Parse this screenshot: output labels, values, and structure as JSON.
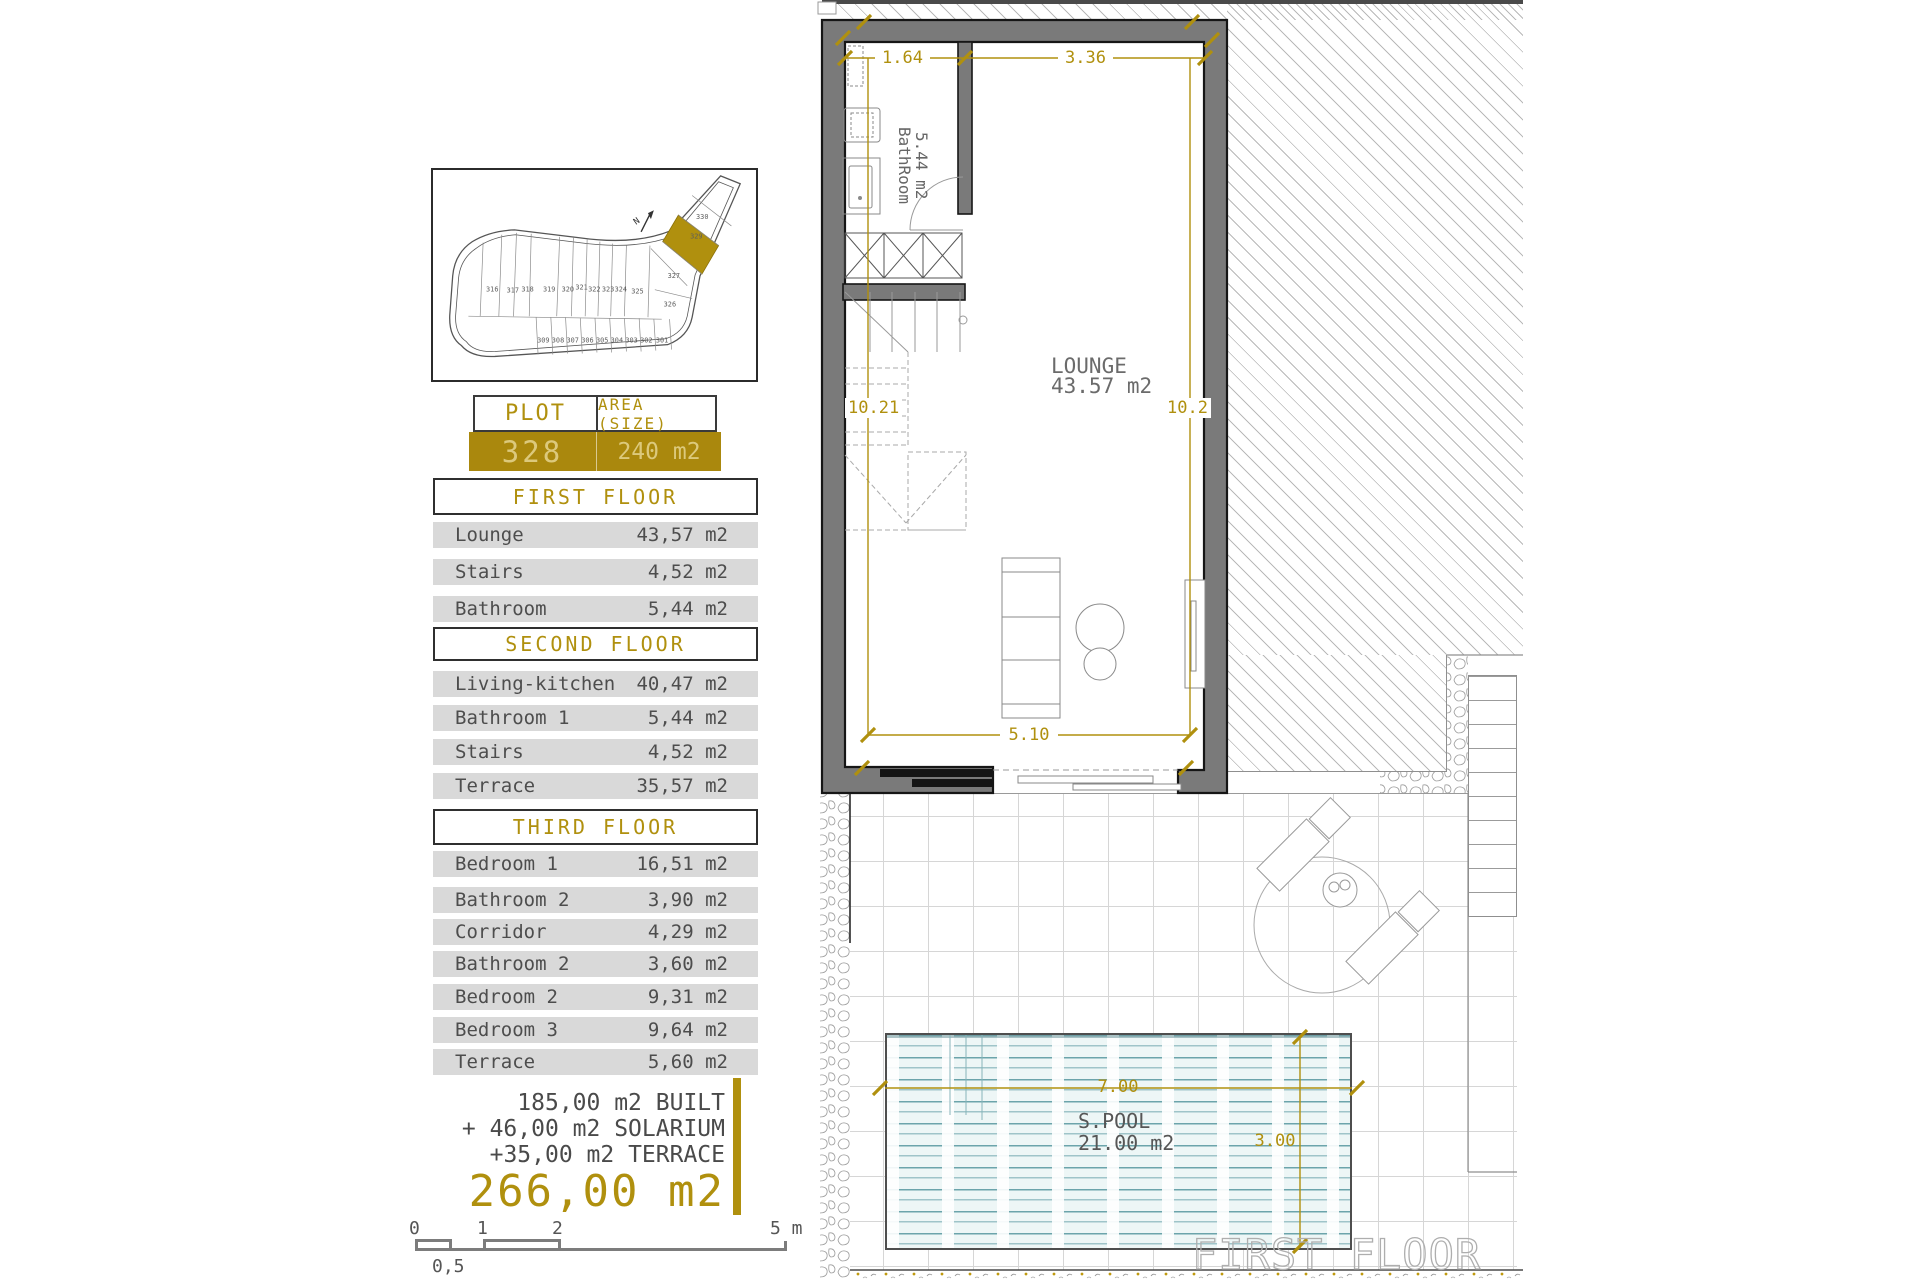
{
  "colors": {
    "accent_gold": "#b0900e",
    "wall_gray": "#7a7a7a",
    "row_gray": "#d9d9d9",
    "water_teal": "#408892"
  },
  "site_plan": {
    "north_label": "N",
    "plots_row_top": [
      "316",
      "317",
      "318",
      "319",
      "320",
      "321",
      "322",
      "323",
      "324",
      "325"
    ],
    "plots_arm": [
      "326",
      "327",
      "329",
      "330"
    ],
    "plots_row_bottom": [
      "309",
      "308",
      "307",
      "306",
      "305",
      "304",
      "303",
      "302",
      "301"
    ],
    "highlighted_plot": "328"
  },
  "plot_table": {
    "col_plot": "PLOT",
    "col_area": "AREA (SIZE)",
    "plot_number": "328",
    "area_value": "240 m2"
  },
  "sections": [
    {
      "title": "FIRST FLOOR",
      "rows": [
        [
          "Lounge",
          "43,57 m2"
        ],
        [
          "Stairs",
          "4,52 m2"
        ],
        [
          "Bathroom",
          "5,44 m2"
        ]
      ]
    },
    {
      "title": "SECOND FLOOR",
      "rows": [
        [
          "Living-kitchen",
          "40,47 m2"
        ],
        [
          "Bathroom 1",
          "5,44 m2"
        ],
        [
          "Stairs",
          "4,52 m2"
        ],
        [
          "Terrace",
          "35,57 m2"
        ]
      ]
    },
    {
      "title": "THIRD FLOOR",
      "rows": [
        [
          "Bedroom 1",
          "16,51 m2"
        ],
        [
          "Bathroom 2",
          "3,90 m2"
        ],
        [
          "Corridor",
          "4,29 m2"
        ],
        [
          "Bathroom 2",
          "3,60 m2"
        ],
        [
          "Bedroom 2",
          "9,31 m2"
        ],
        [
          "Bedroom 3",
          "9,64 m2"
        ],
        [
          "Terrace",
          "5,60 m2"
        ]
      ]
    }
  ],
  "summary": {
    "lines": [
      "185,00 m2 BUILT",
      "+ 46,00 m2 SOLARIUM",
      "+35,00 m2 TERRACE"
    ],
    "total": "266,00 m2"
  },
  "scale_bar": {
    "labels": [
      "0",
      "1",
      "2",
      "5 m"
    ],
    "sub_label": "0,5"
  },
  "floor_plan": {
    "bathroom_name": "BathRoom",
    "bathroom_area": "5.44 m2",
    "lounge_name": "LOUNGE",
    "lounge_area": "43.57 m2",
    "dims": {
      "top_left": "1.64",
      "top_right": "3.36",
      "left": "10.21",
      "right": "10.2",
      "bottom": "5.10"
    },
    "title": "FIRST FLOOR"
  },
  "pool": {
    "name": "S.POOL",
    "area": "21.00 m2",
    "dim_width": "7.00",
    "dim_height": "3.00"
  }
}
